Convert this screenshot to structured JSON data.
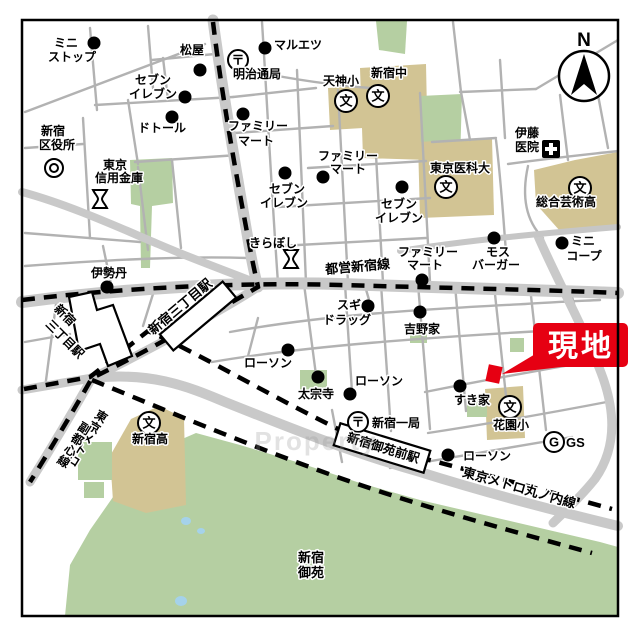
{
  "site": {
    "label": "現地",
    "color": "#e60012"
  },
  "compass": {
    "label": "N"
  },
  "watermark": {
    "text": "Property"
  },
  "colors": {
    "site_red": "#e60012",
    "park_green": "#b5cfa2",
    "school_tan": "#d2c494",
    "water_blue": "#a5d2ea",
    "road_gray": "#c9c9c9",
    "rail_black": "#000000"
  },
  "rail_lines": [
    "都営新宿線",
    "東京メトロ丸ノ内線",
    "東京メトロ副都心線"
  ],
  "stations": [
    "新宿三丁目駅",
    "新宿三丁目駅",
    "新宿御苑前駅"
  ],
  "park_name": "新宿御苑",
  "symbol_glyphs": {
    "school": "文",
    "post": "〒",
    "gas": "G"
  },
  "dots": [
    {
      "n": "ministop",
      "x": 94,
      "y": 43
    },
    {
      "n": "matsuya",
      "x": 200,
      "y": 70
    },
    {
      "n": "maruetsu",
      "x": 265,
      "y": 48
    },
    {
      "n": "seveneleven-1",
      "x": 185,
      "y": 97
    },
    {
      "n": "doutor",
      "x": 172,
      "y": 117
    },
    {
      "n": "familymart-1",
      "x": 243,
      "y": 114
    },
    {
      "n": "seveneleven-2",
      "x": 285,
      "y": 173
    },
    {
      "n": "familymart-2",
      "x": 323,
      "y": 177
    },
    {
      "n": "seveneleven-3",
      "x": 402,
      "y": 187
    },
    {
      "n": "isetan",
      "x": 107,
      "y": 287
    },
    {
      "n": "familymart-3",
      "x": 422,
      "y": 280
    },
    {
      "n": "mosburger",
      "x": 494,
      "y": 238
    },
    {
      "n": "minicoop",
      "x": 562,
      "y": 243
    },
    {
      "n": "sugidrug",
      "x": 368,
      "y": 306
    },
    {
      "n": "yoshinoya",
      "x": 420,
      "y": 312
    },
    {
      "n": "lawson-a",
      "x": 288,
      "y": 350
    },
    {
      "n": "taisoji",
      "x": 318,
      "y": 377
    },
    {
      "n": "lawson-b",
      "x": 350,
      "y": 394
    },
    {
      "n": "sukiya",
      "x": 460,
      "y": 386
    },
    {
      "n": "lawson-c",
      "x": 448,
      "y": 455
    }
  ],
  "symbols": [
    {
      "type": "school",
      "n": "tenjin-elementary",
      "x": 346,
      "y": 101
    },
    {
      "type": "school",
      "n": "shinjuku-jhs",
      "x": 378,
      "y": 96
    },
    {
      "type": "school",
      "n": "tokyo-medical-univ",
      "x": 446,
      "y": 187
    },
    {
      "type": "school",
      "n": "sogo-geijutsu-hs",
      "x": 580,
      "y": 188
    },
    {
      "type": "school",
      "n": "hanazono-elementary",
      "x": 510,
      "y": 407
    },
    {
      "type": "school",
      "n": "shinjuku-hs",
      "x": 149,
      "y": 423
    },
    {
      "type": "post",
      "n": "meijidori-post-office",
      "x": 238,
      "y": 60
    },
    {
      "type": "post",
      "n": "shinjuku-1-post-office",
      "x": 358,
      "y": 422
    },
    {
      "type": "bank",
      "n": "tokyo-shinkin-bank",
      "x": 100,
      "y": 199
    },
    {
      "type": "bank",
      "n": "kiraboshi-bank",
      "x": 291,
      "y": 259
    },
    {
      "type": "gov",
      "n": "shinjuku-ward-office",
      "x": 54,
      "y": 168
    },
    {
      "type": "hospital",
      "n": "ito-clinic",
      "x": 551,
      "y": 149
    },
    {
      "type": "gas",
      "n": "gas-station",
      "x": 554,
      "y": 442
    }
  ],
  "labels": [
    {
      "n": "ministop-1",
      "t": "ミニ",
      "x": 66,
      "y": 47
    },
    {
      "n": "ministop-2",
      "t": "ストップ",
      "x": 72,
      "y": 61
    },
    {
      "n": "matsuya",
      "t": "松屋",
      "x": 192,
      "y": 54
    },
    {
      "n": "maruetsu",
      "t": "マルエツ",
      "x": 298,
      "y": 49
    },
    {
      "n": "meijidori-post",
      "t": "明治通局",
      "x": 257,
      "y": 78
    },
    {
      "n": "seveneleven1-1",
      "t": "セブン",
      "x": 153,
      "y": 84
    },
    {
      "n": "seveneleven1-2",
      "t": "イレブン",
      "x": 153,
      "y": 98
    },
    {
      "n": "doutor",
      "t": "ドトール",
      "x": 162,
      "y": 132
    },
    {
      "n": "ward-office-1",
      "t": "新宿",
      "x": 53,
      "y": 135
    },
    {
      "n": "ward-office-2",
      "t": "区役所",
      "x": 57,
      "y": 149
    },
    {
      "n": "familymart1-1",
      "t": "ファミリー",
      "x": 258,
      "y": 130
    },
    {
      "n": "familymart1-2",
      "t": "マート",
      "x": 256,
      "y": 145
    },
    {
      "n": "shinkin-1",
      "t": "東京",
      "x": 115,
      "y": 169
    },
    {
      "n": "shinkin-2",
      "t": "信用金庫",
      "x": 119,
      "y": 182
    },
    {
      "n": "tenjin-elem",
      "t": "天神小",
      "x": 341,
      "y": 85
    },
    {
      "n": "shinjuku-jhs",
      "t": "新宿中",
      "x": 389,
      "y": 77
    },
    {
      "n": "familymart2-1",
      "t": "ファミリー",
      "x": 348,
      "y": 160
    },
    {
      "n": "familymart2-2",
      "t": "マート",
      "x": 348,
      "y": 173
    },
    {
      "n": "tokyo-medical",
      "t": "東京医科大",
      "x": 460,
      "y": 172
    },
    {
      "n": "ito-clinic-1",
      "t": "伊藤",
      "x": 527,
      "y": 137
    },
    {
      "n": "ito-clinic-2",
      "t": "医院",
      "x": 527,
      "y": 151
    },
    {
      "n": "seveneleven2-1",
      "t": "セブン",
      "x": 287,
      "y": 193
    },
    {
      "n": "seveneleven2-2",
      "t": "イレブン",
      "x": 284,
      "y": 207
    },
    {
      "n": "seveneleven3-1",
      "t": "セブン",
      "x": 399,
      "y": 208
    },
    {
      "n": "seveneleven3-2",
      "t": "イレブン",
      "x": 399,
      "y": 222
    },
    {
      "n": "sogo-geijutsu",
      "t": "総合芸術高",
      "x": 566,
      "y": 206
    },
    {
      "n": "kiraboshi",
      "t": "きらぼし",
      "x": 273,
      "y": 247
    },
    {
      "n": "familymart3-1",
      "t": "ファミリー",
      "x": 428,
      "y": 256
    },
    {
      "n": "familymart3-2",
      "t": "マート",
      "x": 425,
      "y": 269
    },
    {
      "n": "mosburger-1",
      "t": "モス",
      "x": 498,
      "y": 256
    },
    {
      "n": "mosburger-2",
      "t": "バーガー",
      "x": 496,
      "y": 269
    },
    {
      "n": "minicoop-1",
      "t": "ミニ",
      "x": 583,
      "y": 245
    },
    {
      "n": "minicoop-2",
      "t": "コープ",
      "x": 584,
      "y": 260
    },
    {
      "n": "toei-shinjuku-line",
      "t": "都営新宿線",
      "x": 358,
      "y": 271,
      "r": -5,
      "s": 13
    },
    {
      "n": "isetan",
      "t": "伊勢丹",
      "x": 109,
      "y": 277
    },
    {
      "n": "sugidrug-1",
      "t": "スギ",
      "x": 349,
      "y": 309
    },
    {
      "n": "sugidrug-2",
      "t": "ドラッグ",
      "x": 347,
      "y": 324
    },
    {
      "n": "yoshinoya",
      "t": "吉野家",
      "x": 422,
      "y": 333
    },
    {
      "n": "lawson-a",
      "t": "ローソン",
      "x": 268,
      "y": 367
    },
    {
      "n": "taisoji",
      "t": "太宗寺",
      "x": 316,
      "y": 398
    },
    {
      "n": "lawson-b",
      "t": "ローソン",
      "x": 379,
      "y": 385
    },
    {
      "n": "shinjuku-1-post",
      "t": "新宿一局",
      "x": 372,
      "y": 427,
      "a": "start"
    },
    {
      "n": "sukiya",
      "t": "すき家",
      "x": 472,
      "y": 404
    },
    {
      "n": "hanazono-elem",
      "t": "花園小",
      "x": 511,
      "y": 429
    },
    {
      "n": "gs",
      "t": "GS",
      "x": 566,
      "y": 447,
      "a": "start",
      "s": 13
    },
    {
      "n": "lawson-c",
      "t": "ローソン",
      "x": 487,
      "y": 460
    },
    {
      "n": "marunouchi-line",
      "t": "東京メトロ丸ノ内線",
      "x": 518,
      "y": 492,
      "r": 16,
      "s": 13
    },
    {
      "n": "gyoen-1",
      "t": "新宿",
      "x": 311,
      "y": 562,
      "s": 13
    },
    {
      "n": "gyoen-2",
      "t": "御苑",
      "x": 311,
      "y": 577,
      "s": 13
    },
    {
      "n": "shinjuku-hs",
      "t": "新宿高",
      "x": 150,
      "y": 443
    },
    {
      "n": "station-sanchome-left-1",
      "t": "新宿",
      "x": 62,
      "y": 318,
      "r": 45
    },
    {
      "n": "station-sanchome-left-2",
      "t": "三丁目駅",
      "x": 62,
      "y": 342,
      "r": 45
    },
    {
      "n": "station-sanchome-center",
      "t": "新宿三丁目駅",
      "x": 183,
      "y": 310,
      "r": -40,
      "s": 13
    },
    {
      "n": "station-gyoemmae",
      "t": "新宿御苑前駅",
      "x": 382,
      "y": 452,
      "r": 17,
      "s": 12.5
    }
  ],
  "vlabels": [
    {
      "n": "fukutoshin-line-1",
      "t": "東京メトロ",
      "x": 99,
      "y": 420,
      "r": 32
    },
    {
      "n": "fukutoshin-line-2",
      "t": "副都心線",
      "x": 82,
      "y": 432,
      "r": 32
    }
  ]
}
